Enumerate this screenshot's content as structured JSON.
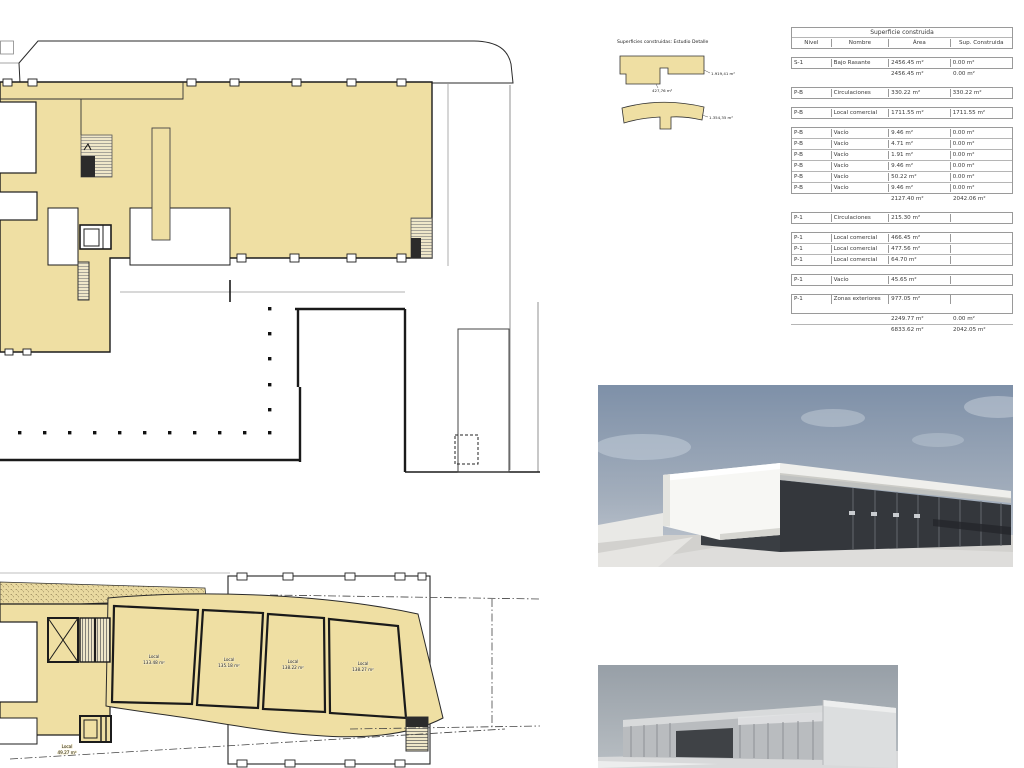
{
  "sheet": {
    "background": "#ffffff"
  },
  "colors": {
    "plan_fill": "#efdfa3",
    "plan_line": "#1c1c1c",
    "table_border": "#9a9a9a",
    "table_text": "#3a3a3a"
  },
  "legend": {
    "title": "Superficies construidas: Estudio Detalle",
    "shape1_label_top": "1.919,41 m²",
    "shape1_label_bottom": "427,76 m²",
    "shape2_label": "1.354,35 m²"
  },
  "schedule": {
    "title": "Superficie construida",
    "columns": [
      "Nivel",
      "Nombre",
      "Área",
      "Sup. Construida"
    ],
    "rows": [
      {
        "nivel": "S-1",
        "nombre": "Bajo Rasante",
        "area": "2456.45 m²",
        "sup": "0.00 m²"
      },
      {
        "nivel": "",
        "nombre": "",
        "area": "2456.45 m²",
        "sup": "0.00 m²"
      },
      {
        "nivel": "P-B",
        "nombre": "Circulaciones",
        "area": "330.22 m²",
        "sup": "330.22 m²"
      },
      {
        "nivel": "P-B",
        "nombre": "Local comercial",
        "area": "1711.55 m²",
        "sup": "1711.55 m²"
      },
      {
        "nivel": "P-B",
        "nombre": "Vacío",
        "area": "9.46 m²",
        "sup": "0.00 m²"
      },
      {
        "nivel": "P-B",
        "nombre": "Vacío",
        "area": "4.71 m²",
        "sup": "0.00 m²"
      },
      {
        "nivel": "P-B",
        "nombre": "Vacío",
        "area": "1.91 m²",
        "sup": "0.00 m²"
      },
      {
        "nivel": "P-B",
        "nombre": "Vacío",
        "area": "9.46 m²",
        "sup": "0.00 m²"
      },
      {
        "nivel": "P-B",
        "nombre": "Vacío",
        "area": "50.22 m²",
        "sup": "0.00 m²"
      },
      {
        "nivel": "P-B",
        "nombre": "Vacío",
        "area": "9.46 m²",
        "sup": "0.00 m²"
      },
      {
        "nivel": "",
        "nombre": "",
        "area": "2127.40 m²",
        "sup": "2042.06 m²"
      },
      {
        "nivel": "P-1",
        "nombre": "Circulaciones",
        "area": "215.30 m²",
        "sup": ""
      },
      {
        "nivel": "P-1",
        "nombre": "Local comercial",
        "area": "466.45 m²",
        "sup": ""
      },
      {
        "nivel": "P-1",
        "nombre": "Local comercial",
        "area": "477.56 m²",
        "sup": ""
      },
      {
        "nivel": "P-1",
        "nombre": "Local comercial",
        "area": "64.70 m²",
        "sup": ""
      },
      {
        "nivel": "P-1",
        "nombre": "Vacío",
        "area": "45.65 m²",
        "sup": ""
      },
      {
        "nivel": "P-1",
        "nombre": "Zonas exteriores",
        "area": "977.05 m²",
        "sup": ""
      },
      {
        "nivel": "",
        "nombre": "",
        "area": "2249.77 m²",
        "sup": "0.00 m²"
      },
      {
        "nivel": "",
        "nombre": "",
        "area": "6833.62 m²",
        "sup": "2042.05 m²"
      }
    ]
  },
  "plan_lower": {
    "units": [
      {
        "name": "Local",
        "area": "133.48 m²"
      },
      {
        "name": "Local",
        "area": "135.18 m²"
      },
      {
        "name": "Local",
        "area": "138.22 m²"
      },
      {
        "name": "Local",
        "area": "138.27 m²"
      },
      {
        "name": "Local",
        "area": "49.27 m²"
      }
    ]
  }
}
